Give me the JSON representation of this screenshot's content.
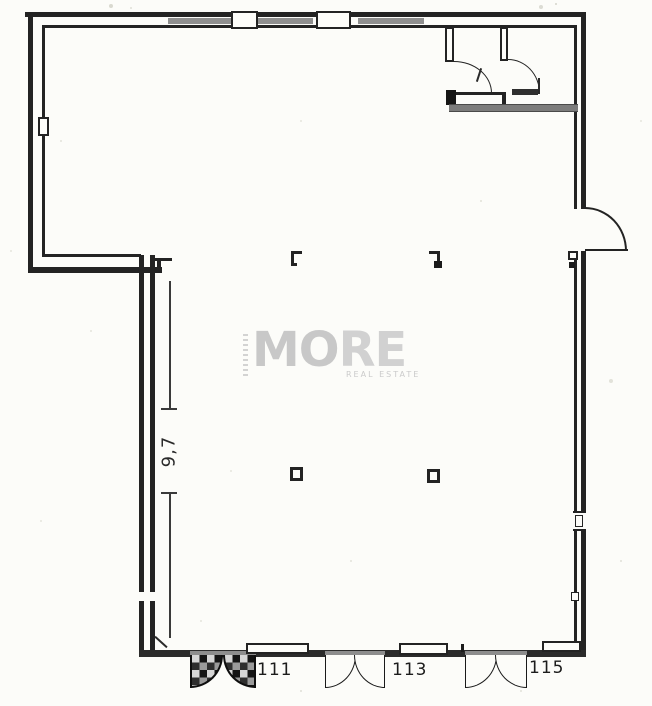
{
  "plan": {
    "dimension": {
      "label": "9,7"
    },
    "units": [
      {
        "label": "111"
      },
      {
        "label": "113"
      },
      {
        "label": "115"
      }
    ],
    "watermark": {
      "letters": [
        "M",
        "O",
        "R",
        "E"
      ],
      "subtitle": "REAL ESTATE"
    },
    "colors": {
      "paper": "#fcfcf9",
      "wall": "#232323",
      "window_band": "#8f8f8f",
      "beam": "#7c7c7c",
      "watermark": "#c8c8c8"
    }
  }
}
